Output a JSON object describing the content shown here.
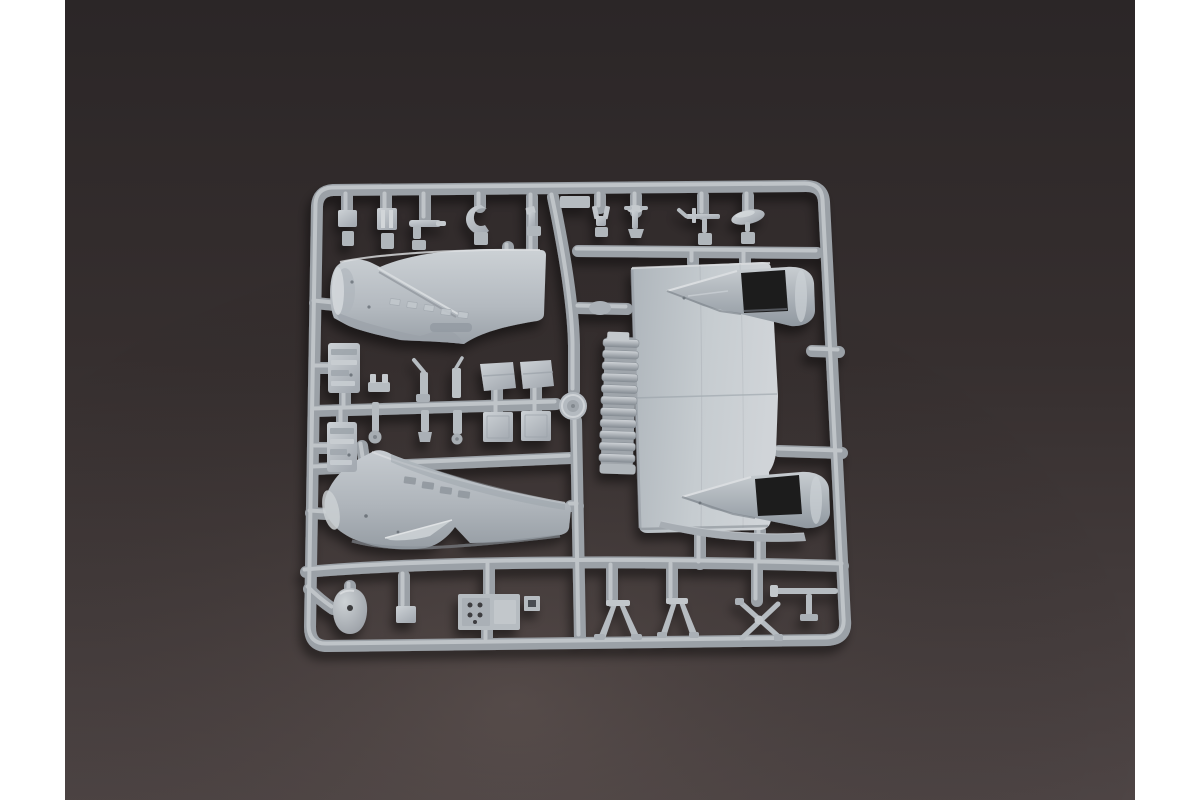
{
  "image_type": "product photograph",
  "caption": "Light grey injection-molded plastic sprue (parts tree) from a model aircraft kit, lying on a dark brown-grey backdrop; white vertical margins border the left and right edges of the photo.",
  "aria_label": "Photograph of a model aircraft kit sprue with fuselage halves, cockpit fairings and many small detail parts",
  "palette": {
    "margin_white": "#FFFFFF",
    "background_top": "#2B2627",
    "background_mid": "#362F2F",
    "background_bottom": "#4E4545",
    "plastic_light": "#CDD2D6",
    "plastic_mid": "#AAB0B6",
    "plastic_shadow": "#8D939A",
    "runner_base": "#9BA1A7",
    "runner_highlight": "#C9CDD1",
    "cockpit_opening_dark": "#1C1C1E"
  },
  "parts": [
    {
      "name": "sprue frame and runner grid"
    },
    {
      "name": "forward fuselage half – upper left"
    },
    {
      "name": "forward fuselage half – lower left"
    },
    {
      "name": "main fuselage panel with twin cockpit fairings"
    },
    {
      "name": "forward cockpit opening"
    },
    {
      "name": "rear cockpit opening"
    },
    {
      "name": "louvered radiator grille"
    },
    {
      "name": "circular hatch disc"
    },
    {
      "name": "cockpit sidewall panel A"
    },
    {
      "name": "cockpit sidewall panel B"
    },
    {
      "name": "landing gear struts and wheel"
    },
    {
      "name": "gear door flaps"
    },
    {
      "name": "square inspection hatches"
    },
    {
      "name": "small antenna, probe and lever parts – top row"
    },
    {
      "name": "dome / spinner part"
    },
    {
      "name": "instrument panel with dial holes"
    },
    {
      "name": "V-brace gear struts"
    },
    {
      "name": "crossed brace rods"
    },
    {
      "name": "pitot probe with tee fitting"
    }
  ]
}
